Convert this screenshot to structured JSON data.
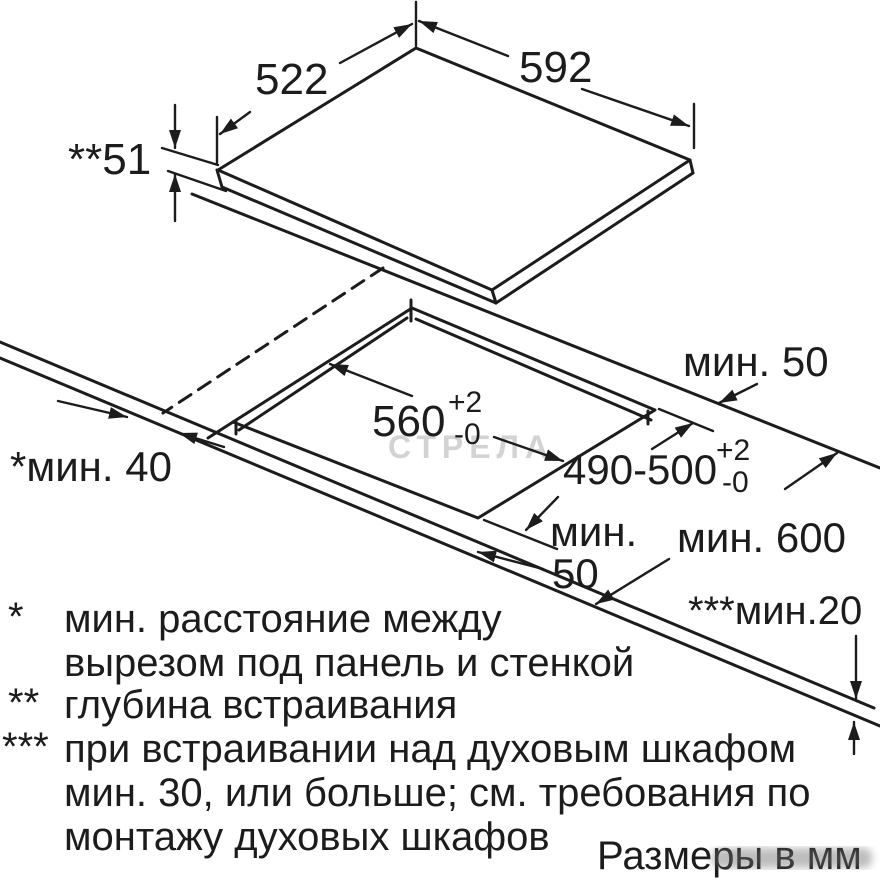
{
  "colors": {
    "ink": "#1c1c1c",
    "paper": "#ffffff",
    "watermark": "#c9c9c9"
  },
  "drawing": {
    "panel": {
      "width_label": "592",
      "depth_label": "522",
      "build_in_depth_label": "**51"
    },
    "cutout": {
      "width_label": "560",
      "width_tol_sup": "+2",
      "width_tol_sub": "-0",
      "depth_label": "490-500",
      "depth_tol_sup": "+2",
      "depth_tol_sub": "-0"
    },
    "clearances": {
      "back_min": "мин. 50",
      "wall_min": "*мин. 40",
      "front_min_line1": "мин.",
      "front_min_line2": "50",
      "counter_depth_min": "мин. 600",
      "edge_min": "***мин.20"
    }
  },
  "footnotes": {
    "f1_marker": "*",
    "f1_line1": "мин. расстояние между",
    "f1_line2": "вырезом под панель и стенкой",
    "f2_marker": "**",
    "f2_line1": "глубина встраивания",
    "f3_marker": "***",
    "f3_line1": "при встраивании над духовым шкафом",
    "f3_line2": "мин. 30, или больше; см. требования по",
    "f3_line3": "монтажу духовых шкафов"
  },
  "units_note": "Размеры в мм",
  "watermark_text": "СТРЕЛА"
}
